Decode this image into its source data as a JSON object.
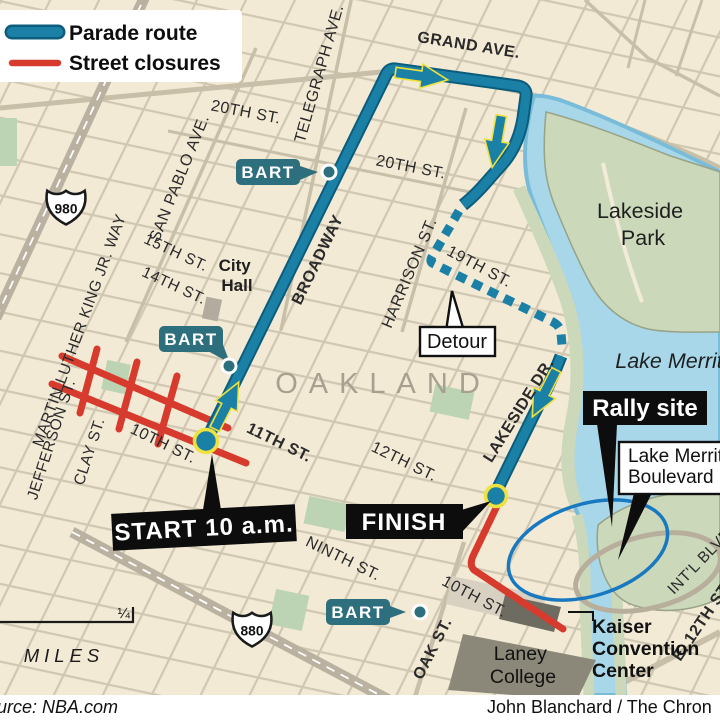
{
  "legend": {
    "parade_route": "Parade route",
    "street_closures": "Street closures"
  },
  "callouts": {
    "bart": "BART",
    "detour": "Detour",
    "start": "START 10 a.m.",
    "finish": "FINISH",
    "rally_site": "Rally site",
    "lake_merritt_blvd_line1": "Lake Merritt",
    "lake_merritt_blvd_line2": "Boulevard"
  },
  "streets": {
    "grand_ave": "GRAND AVE.",
    "telegraph": "TELEGRAPH AVE.",
    "twentieth_w": "20TH ST.",
    "twentieth_e": "20TH ST.",
    "san_pablo": "SAN PABLO AVE.",
    "broadway": "BROADWAY",
    "harrison": "HARRISON ST.",
    "nineteenth": "19TH ST.",
    "fifteenth": "15TH ST.",
    "fourteenth": "14TH ST.",
    "mlk": "MARTIN LUTHER KING JR. WAY",
    "jefferson": "JEFFERSON ST.",
    "clay": "CLAY ST.",
    "tenth_w": "10TH ST.",
    "eleventh": "11TH ST.",
    "twelfth": "12TH ST.",
    "ninth": "NINTH ST.",
    "tenth_e": "10TH ST.",
    "oak": "OAK ST.",
    "lakeside_dr": "LAKESIDE DR.",
    "intl": "INT'L BLVD.",
    "e_twelfth": "E. 12TH ST."
  },
  "places": {
    "city_hall_1": "City",
    "city_hall_2": "Hall",
    "oakland": "OAKLAND",
    "lakeside_park_1": "Lakeside",
    "lakeside_park_2": "Park",
    "lake_merritt": "Lake Merritt",
    "laney_1": "Laney",
    "laney_2": "College",
    "kaiser_1": "Kaiser",
    "kaiser_2": "Convention",
    "kaiser_3": "Center"
  },
  "highways": {
    "i980": "980",
    "i880": "880"
  },
  "scale": {
    "quarter": "¼",
    "miles": "MILES"
  },
  "footer": {
    "source": "urce: NBA.com",
    "credit": "John Blanchard / The Chron"
  },
  "colors": {
    "route": "#1a80a6",
    "route_casing": "#0c5c7c",
    "closure": "#d63b2d",
    "water": "#a9d7ea",
    "water_edge": "#79bcd9",
    "park": "#ccd8ba",
    "bart": "#2e6f7e",
    "arrow_outline": "#efe13e",
    "map_bg": "#f3ead6",
    "street": "#cfc7b2",
    "ellipse": "#1879c0"
  }
}
